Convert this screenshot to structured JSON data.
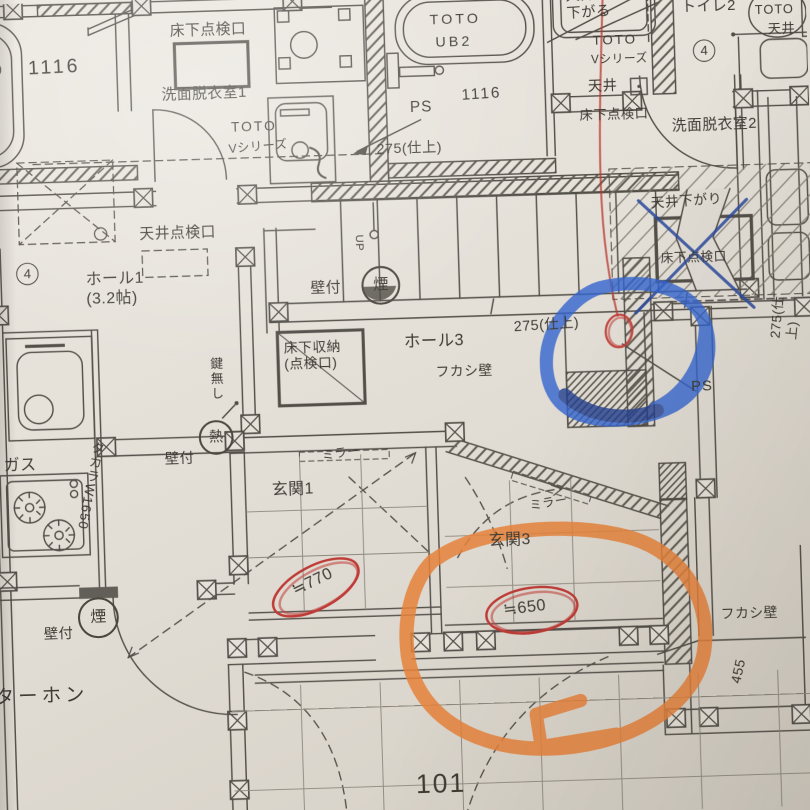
{
  "labels": {
    "dim_bath_left": "1116",
    "underfloor_hatch_1": "床下点検口",
    "washroom_1": "洗面脱衣室1",
    "toto_1": "TOTO",
    "vseries_1": "Vシリーズ",
    "toto_ub": "TOTO",
    "ub2": "UB2",
    "dim_bath_ub": "1116",
    "ps_1": "PS",
    "finish275_1": "275(仕上)",
    "ceiling_lowered": "天井\n下がる",
    "toilet2": "トイレ2",
    "toto_toilet": "TOTO",
    "ceiling_r": "天井",
    "toto_2": "TOTO",
    "vseries_2": "Vシリーズ",
    "ceiling_m": "天井",
    "underfloor_hatch_2": "床下点検口",
    "washroom_2": "洗面脱衣室2",
    "num4_r": "4",
    "num4_l": "4",
    "ceiling_hatch": "天井点検口",
    "hall1": "ホール1\n(3.2帖)",
    "no_key": "鍵無し",
    "heat": "熱",
    "wall_mount_1": "壁付",
    "gas": "ガス",
    "takara": "タカラW1650",
    "up": "UP",
    "smoke_1": "煙",
    "wall_mount_2": "壁付",
    "underfloor_storage": "床下収納\n(点検口)",
    "hall3": "ホール3",
    "fukashi_1": "フカシ壁",
    "finish275_2": "275(仕上)",
    "ps_2": "PS",
    "finish275_3": "275(仕上)",
    "ceiling_drop": "天井下がり",
    "underfloor_hatch_3": "床下点検口",
    "mirror_1": "ミラー",
    "genkan1": "玄関1",
    "dim770": "≒770",
    "mirror_3": "ミラー",
    "genkan3": "玄関3",
    "dim650": "≒650",
    "fukashi_2": "フカシ壁",
    "dim455": "455",
    "smoke_2": "煙",
    "wall_mount_3": "壁付",
    "interphone": "ターホン",
    "room_no": "101"
  },
  "marks": {
    "blue_marker": "#3465cf",
    "orange_marker": "#e5813a",
    "red_pen": "#bf3b36",
    "blue_pen": "#2c4a9e",
    "ink": "#45423c"
  }
}
